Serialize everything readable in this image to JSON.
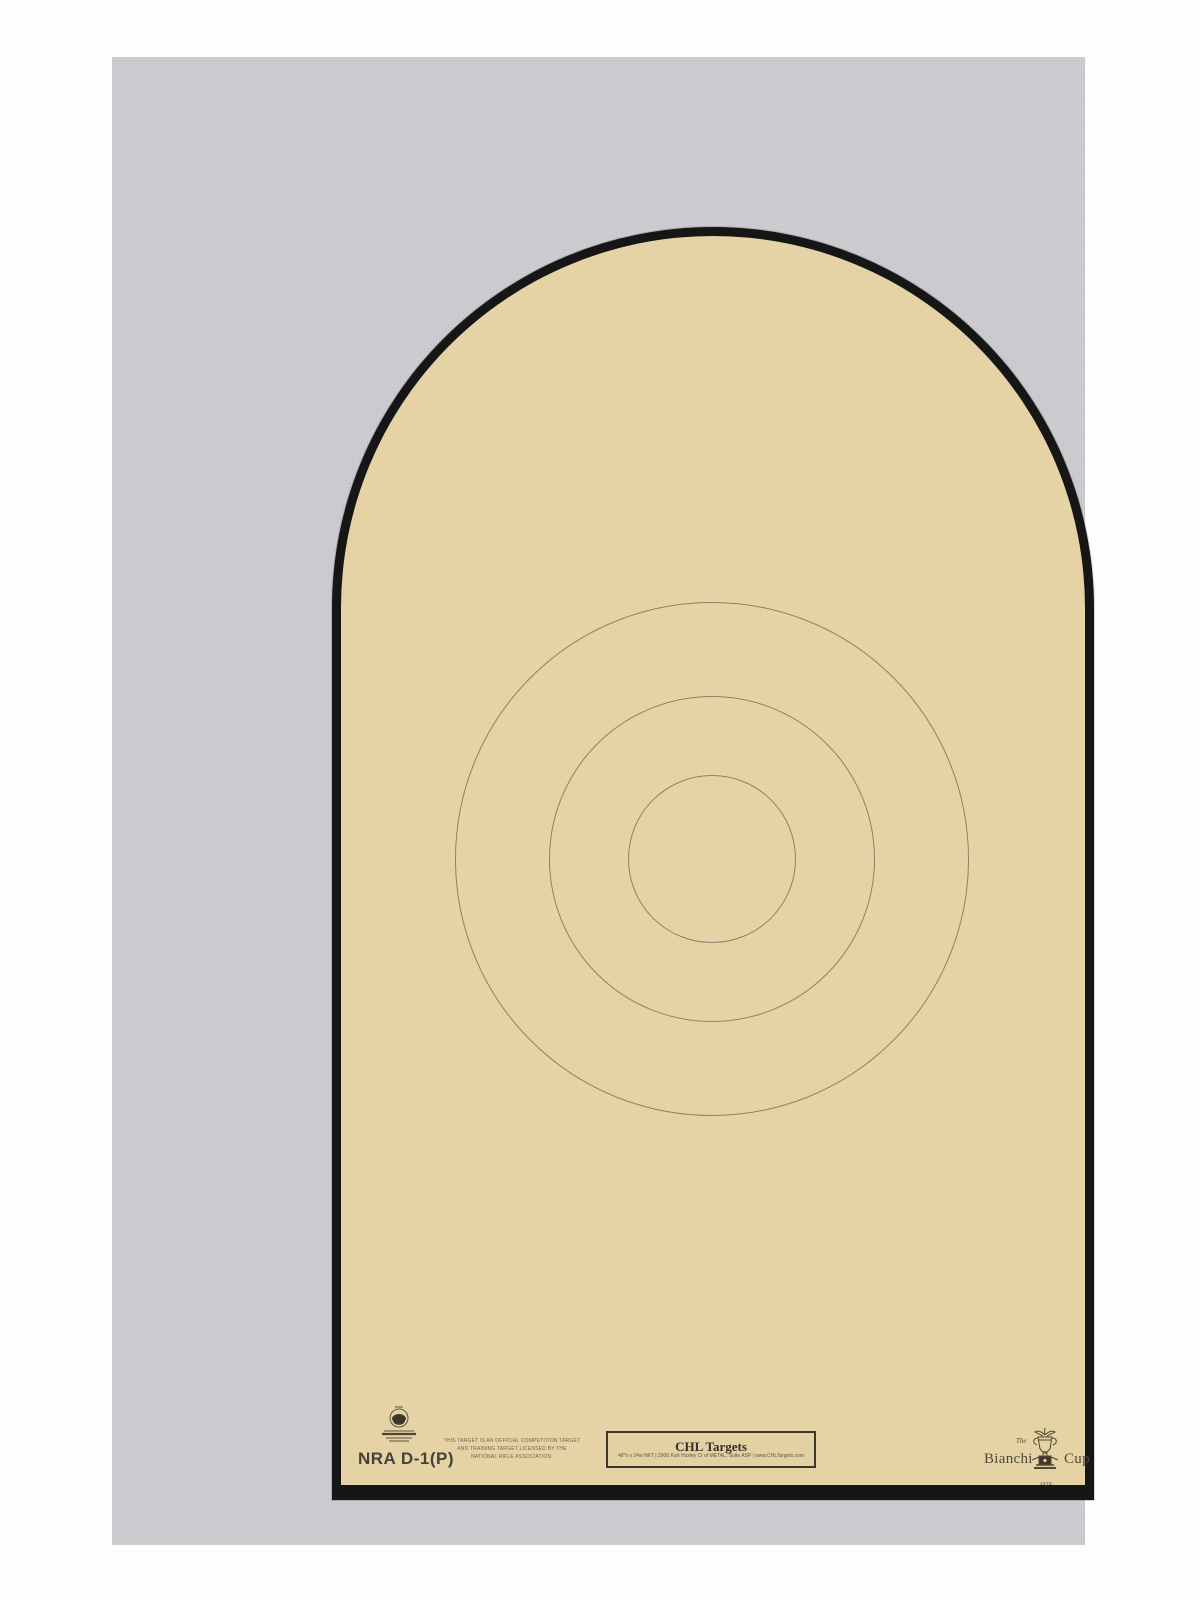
{
  "page": {
    "background_color": "#ffffff",
    "sheet_color": "#cbcbd0"
  },
  "target": {
    "model_label": "NRA  D-1(P)",
    "face_color": "#e6d3a5",
    "border_color": "#161616",
    "ring_color": "#8c8168",
    "rings": [
      {
        "name": "outer-scoring-ring",
        "radius_px": 257
      },
      {
        "name": "middle-scoring-ring",
        "radius_px": 163
      },
      {
        "name": "center-scoring-ring",
        "radius_px": 84
      }
    ],
    "center_px": {
      "x": 600,
      "y": 802
    }
  },
  "footer": {
    "nra_seal_icon": "nra-official-seal",
    "license": {
      "line1": "THIS TARGET IS AN OFFICIAL COMPETITION TARGET",
      "line2": "AND TRAINING TARGET LICENSED BY THE",
      "line3": "NATIONAL RIFLE ASSOCIATION."
    },
    "maker_box": {
      "title": "CHL Targets",
      "details": "48\"h x 24w NKT   |   2900 Kurt Huxley Ct of METAL, Suite ASP   |   www.CHLTargets.com"
    },
    "bianchi": {
      "the": "The",
      "word_left": "Bianchi",
      "word_right": "Cup",
      "year": "1979",
      "trophy_icon": "trophy-cup"
    }
  }
}
